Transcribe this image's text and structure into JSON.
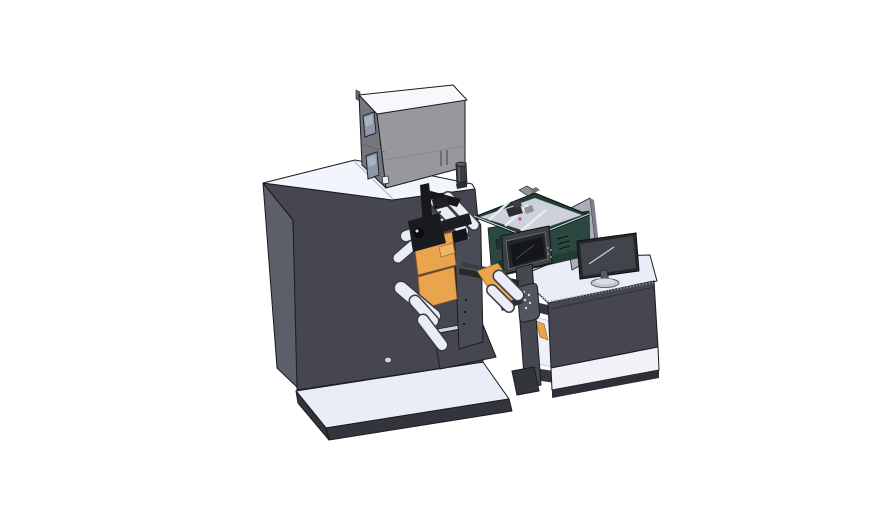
{
  "colors": {
    "bg": "#ffffff",
    "panel_light": "#e9edf7",
    "panel_lighter": "#f2f5fb",
    "machine_dark": "#45464f",
    "machine_side": "#5c5e69",
    "machine_deep": "#33343c",
    "box_front": "#97989d",
    "box_side": "#75767c",
    "box_top": "#f6f8fb",
    "window_glass": "#8d99ab",
    "roller_white": "#eaedf5",
    "roller_edge": "#3b3c44",
    "accent_orange": "#e9a44d",
    "teal_dark": "#2a483f",
    "teal_deep": "#203c33",
    "tray_inner": "#ccd1da",
    "hmi_bezel": "#3e4245",
    "hmi_screen": "#141619",
    "monitor_bezel": "#26272b",
    "monitor_screen": "#42444c",
    "panel_gray": "#a9aeb9",
    "magenta_chip": "#c24ec2",
    "black_part": "#17181b",
    "edge": "#1b1c20"
  },
  "scene": {
    "type": "3d-cad-render",
    "background": "#ffffff",
    "parts": [
      {
        "id": "base-platform",
        "color": "#e9edf7"
      },
      {
        "id": "main-tower",
        "color": "#45464f"
      },
      {
        "id": "control-box",
        "color": "#97989d"
      },
      {
        "id": "vent-cylinder",
        "color": "#3b3c42"
      },
      {
        "id": "print-mechanism",
        "color": "#17181b"
      },
      {
        "id": "web-rollers",
        "color": "#eaedf5"
      },
      {
        "id": "media-plates",
        "color": "#e9a44d"
      },
      {
        "id": "hmi-unit",
        "color": "#2a483f"
      },
      {
        "id": "parts-tray",
        "color": "#ccd1da"
      },
      {
        "id": "handle-column",
        "color": "#46484f"
      },
      {
        "id": "operator-desk",
        "color": "#45464f"
      },
      {
        "id": "desk-monitor",
        "color": "#26272b"
      },
      {
        "id": "divider-panel",
        "color": "#a9aeb9"
      }
    ]
  }
}
